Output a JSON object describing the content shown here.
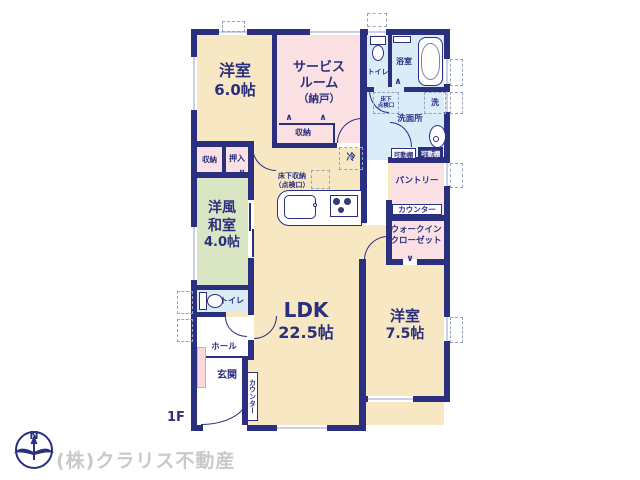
{
  "colors": {
    "wall_navy": "#2a2f80",
    "room_cream": "#f7e8c3",
    "room_pink": "#fbe1e3",
    "room_green": "#dae6c3",
    "room_blue": "#daecf7",
    "window_gray": "#9aa2c6",
    "company_gray": "#c9c9c9"
  },
  "floor": {
    "label": "1F"
  },
  "compass": {
    "label": "N"
  },
  "company": {
    "name": "(株)クラリス不動産"
  },
  "rooms": {
    "western6": {
      "name": "洋室",
      "size": "6.0帖"
    },
    "service_room": {
      "line1": "サービス",
      "line2": "ルーム",
      "line3": "（納戸）"
    },
    "toilet_upper": {
      "name": "トイレ"
    },
    "bathroom": {
      "name": "浴室"
    },
    "washroom": {
      "name": "洗面所"
    },
    "pantry": {
      "name": "パントリー"
    },
    "walk_in_closet": {
      "line1": "ウォークイン",
      "line2": "クローゼット"
    },
    "western75": {
      "name": "洋室",
      "size": "7.5帖"
    },
    "ldk": {
      "name": "LDK",
      "size": "22.5帖"
    },
    "washitsu": {
      "line1": "洋風",
      "line2": "和室",
      "size": "4.0帖"
    },
    "toilet_lower": {
      "name": "トイレ"
    },
    "hall": {
      "name": "ホール"
    },
    "entrance": {
      "name": "玄関"
    }
  },
  "fixtures": {
    "closet_small": "収納",
    "oshiire": "押入",
    "service_closet": "収納",
    "refrigerator": "冷",
    "underfloor_storage": {
      "line1": "床下収納",
      "line2": "（点検口）"
    },
    "underfloor_hatch": {
      "line1": "床下",
      "line2": "点検口"
    },
    "washer": "洗",
    "movable_shelf_left": "可動棚",
    "movable_shelf_right": "可動棚",
    "counter_pantry": "カウンター",
    "counter_ldk": "カウンター"
  }
}
